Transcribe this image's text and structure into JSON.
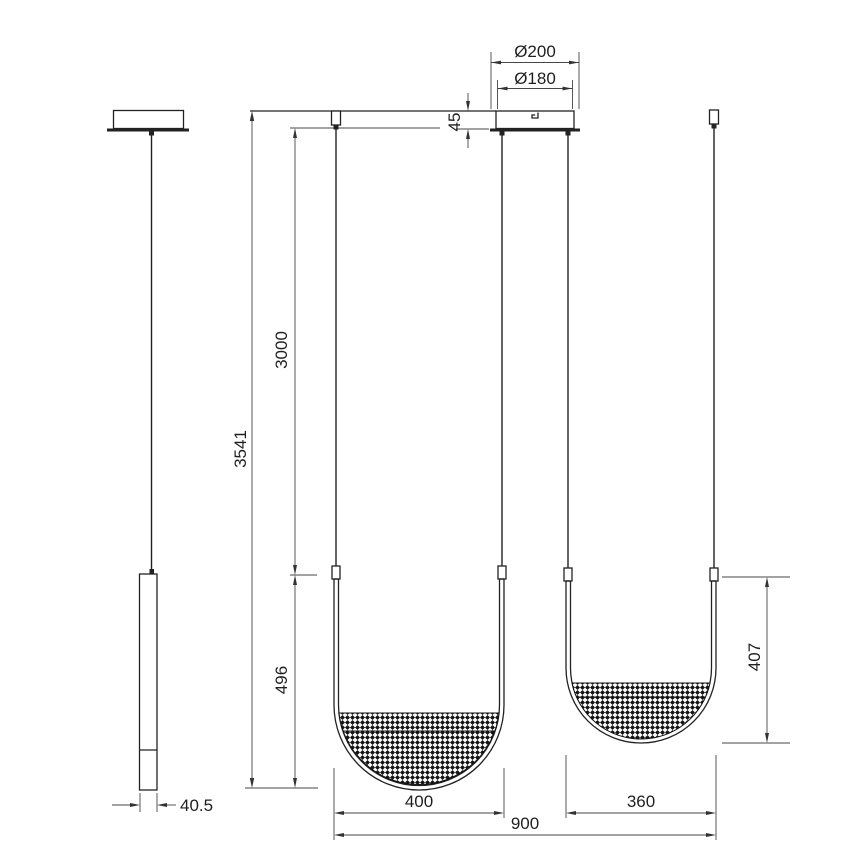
{
  "drawing": {
    "type": "pendant-lamp-technical-dimension-drawing",
    "dimensions": {
      "canopy_diameter_outer": "Ø200",
      "canopy_diameter_inner": "Ø180",
      "canopy_height": "45",
      "suspension_length": "3000",
      "total_height": "3541",
      "pendant_left_drop": "496",
      "pendant_right_height": "407",
      "pendant_left_width": "400",
      "pendant_right_width": "360",
      "overall_width": "900",
      "tube_depth": "40.5"
    },
    "colors": {
      "object_line": "#222222",
      "dimension_line": "#474747",
      "hatch_fill": "#141414",
      "background": "#ffffff"
    }
  }
}
